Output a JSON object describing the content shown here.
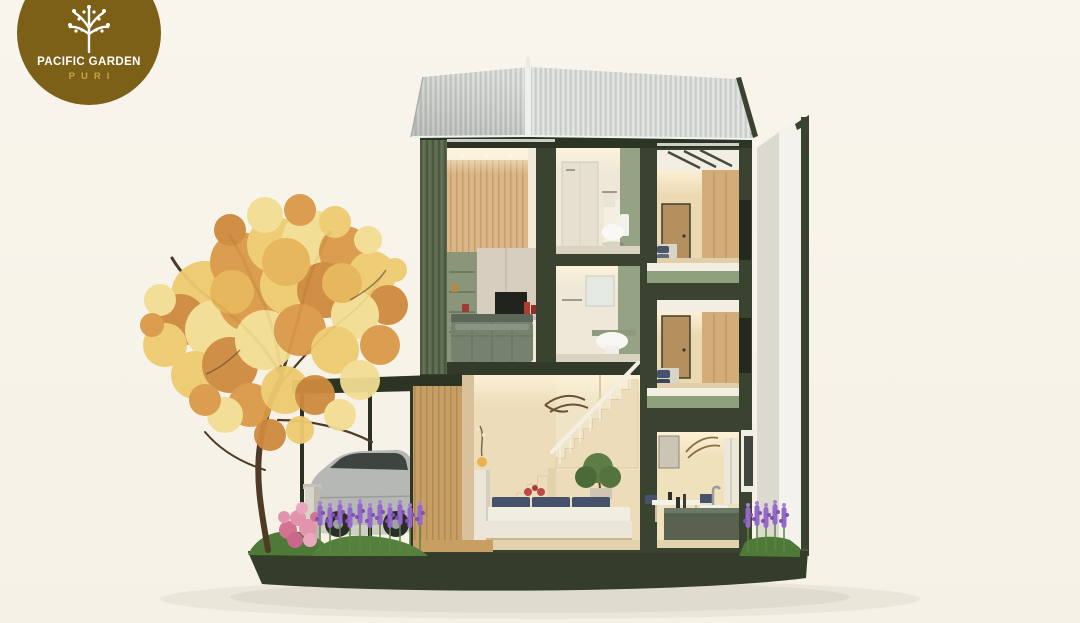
{
  "logo": {
    "brand": "PACIFIC GARDEN",
    "subtitle": "PURI",
    "icon": "tree-logo-icon"
  },
  "scene": {
    "description": "3D cutaway render of a three-storey Pacific Garden Puri townhouse: gabled metal roof, master suite, two stacked bathrooms, two bedrooms, double-height living room with staircase, dining-kitchen, carport with silver car, autumn tree and flower gardens on a dark green base platform"
  },
  "palette": {
    "bg": "#f8f5ec",
    "logo-brown": "#7d6018",
    "logo-gold": "#c9a24a",
    "logo-text": "#ffffff",
    "house-green": "#39432f",
    "house-green-dark": "#2c3423",
    "wall-rib-green": "#5a684c",
    "roof-gray": "#d4d7d2",
    "interior-warm": "#eddcb9",
    "wood": "#dcb585",
    "sage": "#95a384",
    "foliage-yellow": "#eecb70",
    "foliage-orange": "#da9a48",
    "flower-purple": "#9569c9",
    "flower-pink": "#e294ad",
    "grass-green": "#4e7937",
    "car-silver": "#b5b8b5",
    "base-shadow": "#dedacc"
  }
}
